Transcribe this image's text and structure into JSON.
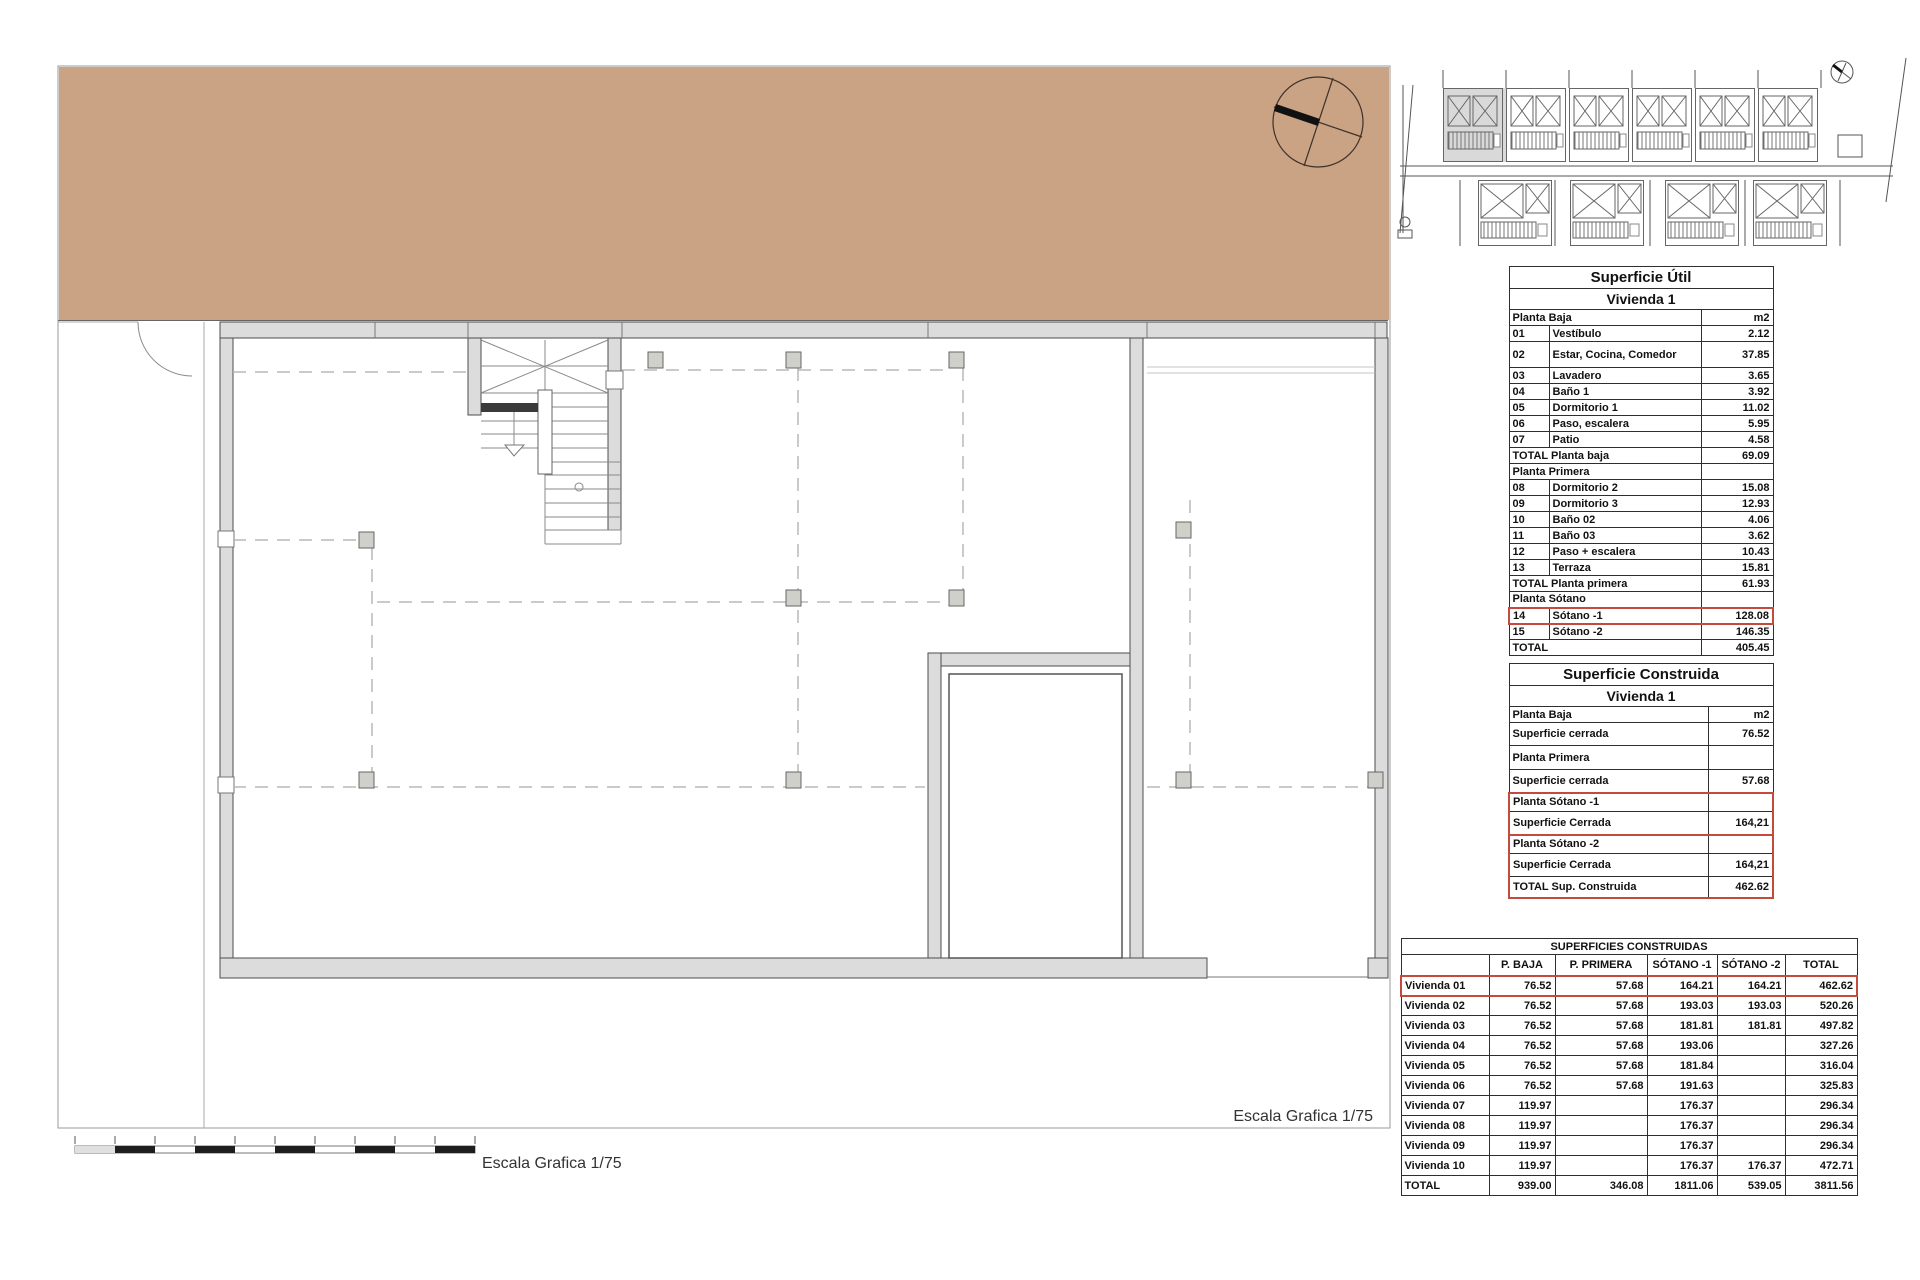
{
  "page": {
    "escala_label": "Escala Grafica 1/75"
  },
  "colors": {
    "earth": "#CAA284",
    "wall_fill": "#DCDCDC",
    "wall_stroke": "#4D4D4D",
    "highlight_red": "#C24B3E"
  },
  "icons": {
    "north_arrow": "compass-north-arrow",
    "thumb_north_arrow": "compass-north-arrow-small"
  },
  "superficie_util": {
    "title": "Superficie Útil",
    "subtitle": "Vivienda 1",
    "rows": [
      {
        "k": "unit",
        "l": "Planta Baja",
        "v": "m2"
      },
      {
        "k": "item",
        "n": "01",
        "l": "Vestíbulo",
        "v": "2.12"
      },
      {
        "k": "item",
        "n": "02",
        "l": "Estar, Cocina, Comedor",
        "v": "37.85"
      },
      {
        "k": "item",
        "n": "03",
        "l": "Lavadero",
        "v": "3.65"
      },
      {
        "k": "item",
        "n": "04",
        "l": "Baño 1",
        "v": "3.92"
      },
      {
        "k": "item",
        "n": "05",
        "l": "Dormitorio 1",
        "v": "11.02"
      },
      {
        "k": "item",
        "n": "06",
        "l": "Paso, escalera",
        "v": "5.95"
      },
      {
        "k": "item",
        "n": "07",
        "l": "Patio",
        "v": "4.58"
      },
      {
        "k": "tot",
        "l": "TOTAL Planta baja",
        "v": "69.09"
      },
      {
        "k": "sec",
        "l": "Planta Primera"
      },
      {
        "k": "item",
        "n": "08",
        "l": "Dormitorio 2",
        "v": "15.08"
      },
      {
        "k": "item",
        "n": "09",
        "l": "Dormitorio 3",
        "v": "12.93"
      },
      {
        "k": "item",
        "n": "10",
        "l": "Baño 02",
        "v": "4.06"
      },
      {
        "k": "item",
        "n": "11",
        "l": "Baño 03",
        "v": "3.62"
      },
      {
        "k": "item",
        "n": "12",
        "l": "Paso + escalera",
        "v": "10.43"
      },
      {
        "k": "item",
        "n": "13",
        "l": "Terraza",
        "v": "15.81"
      },
      {
        "k": "tot",
        "l": "TOTAL Planta primera",
        "v": "61.93"
      },
      {
        "k": "sec",
        "l": "Planta Sótano"
      },
      {
        "k": "item",
        "n": "14",
        "l": "Sótano -1",
        "v": "128.08",
        "hl": "tb"
      },
      {
        "k": "item",
        "n": "15",
        "l": "Sótano -2",
        "v": "146.35"
      },
      {
        "k": "tot",
        "l": "TOTAL",
        "v": "405.45"
      }
    ]
  },
  "superficie_construida": {
    "title": "Superficie Construida",
    "subtitle": "Vivienda 1",
    "rows": [
      {
        "k": "unit",
        "l": "Planta Baja",
        "v": "m2"
      },
      {
        "k": "row",
        "l": "Superficie cerrada",
        "v": "76.52"
      },
      {
        "k": "sec",
        "l": "Planta Primera"
      },
      {
        "k": "row",
        "l": "Superficie cerrada",
        "v": "57.68"
      },
      {
        "k": "sec",
        "l": "Planta Sótano -1",
        "hl": "t"
      },
      {
        "k": "row",
        "l": "Superficie Cerrada",
        "v": "164,21",
        "hl": "b"
      },
      {
        "k": "sec",
        "l": "Planta Sótano -2",
        "hl": "t"
      },
      {
        "k": "row",
        "l": "Superficie Cerrada",
        "v": "164,21",
        "hl": "m"
      },
      {
        "k": "tot",
        "l": "TOTAL Sup. Construida",
        "v": "462.62",
        "hl": "b"
      }
    ]
  },
  "superficies_construidas": {
    "title": "SUPERFICIES CONSTRUIDAS",
    "columns": [
      "",
      "P. BAJA",
      "P. PRIMERA",
      "SÓTANO -1",
      "SÓTANO -2",
      "TOTAL"
    ],
    "rows": [
      {
        "label": "Vivienda 01",
        "values": [
          "76.52",
          "57.68",
          "164.21",
          "164.21",
          "462.62"
        ],
        "hl": "tb"
      },
      {
        "label": "Vivienda 02",
        "values": [
          "76.52",
          "57.68",
          "193.03",
          "193.03",
          "520.26"
        ]
      },
      {
        "label": "Vivienda 03",
        "values": [
          "76.52",
          "57.68",
          "181.81",
          "181.81",
          "497.82"
        ]
      },
      {
        "label": "Vivienda 04",
        "values": [
          "76.52",
          "57.68",
          "193.06",
          "",
          "327.26"
        ]
      },
      {
        "label": "Vivienda 05",
        "values": [
          "76.52",
          "57.68",
          "181.84",
          "",
          "316.04"
        ]
      },
      {
        "label": "Vivienda 06",
        "values": [
          "76.52",
          "57.68",
          "191.63",
          "",
          "325.83"
        ]
      },
      {
        "label": "Vivienda 07",
        "values": [
          "119.97",
          "",
          "176.37",
          "",
          "296.34"
        ]
      },
      {
        "label": "Vivienda 08",
        "values": [
          "119.97",
          "",
          "176.37",
          "",
          "296.34"
        ]
      },
      {
        "label": "Vivienda 09",
        "values": [
          "119.97",
          "",
          "176.37",
          "",
          "296.34"
        ]
      },
      {
        "label": "Vivienda 10",
        "values": [
          "119.97",
          "",
          "176.37",
          "176.37",
          "472.71"
        ]
      },
      {
        "label": "TOTAL",
        "values": [
          "939.00",
          "346.08",
          "1811.06",
          "539.05",
          "3811.56"
        ]
      }
    ]
  }
}
